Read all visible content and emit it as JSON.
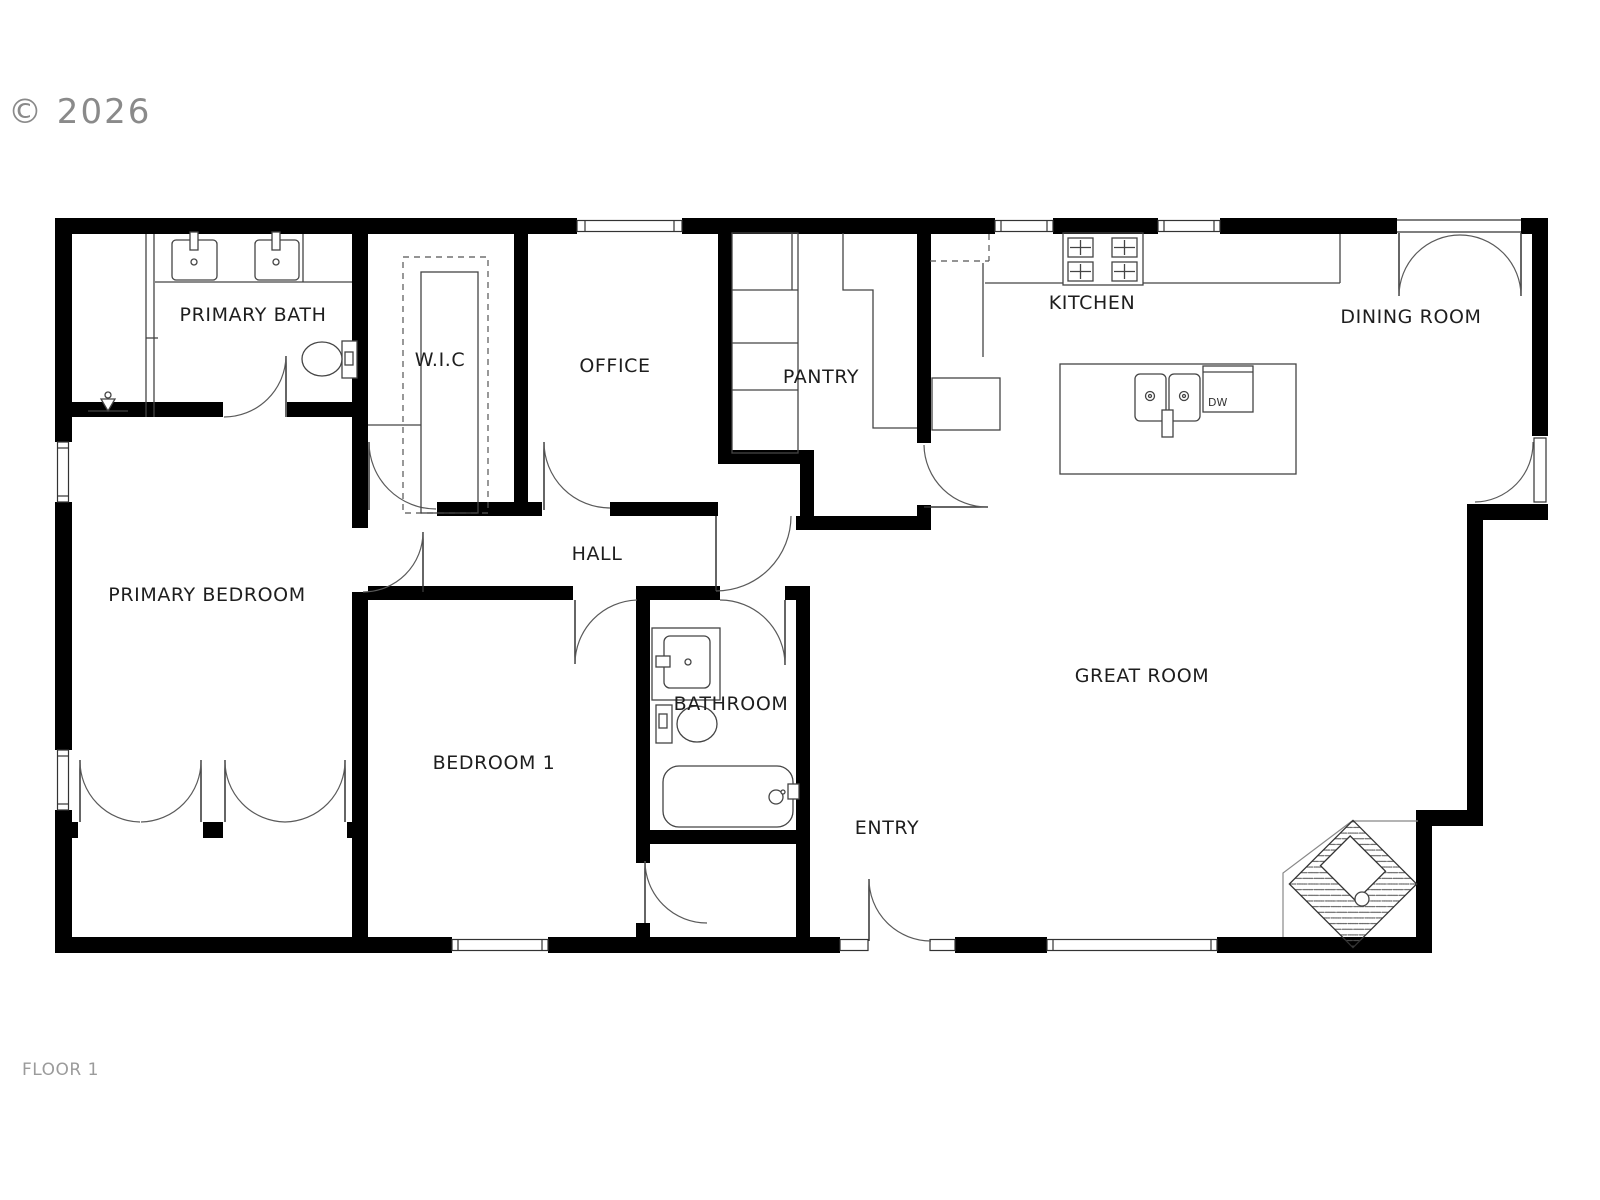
{
  "watermark": "© 2026",
  "floor": {
    "label": "FLOOR 1"
  },
  "rooms": {
    "primary_bath": "PRIMARY BATH",
    "wic": "W.I.C",
    "office": "OFFICE",
    "pantry": "PANTRY",
    "kitchen": "KITCHEN",
    "dining_room": "DINING ROOM",
    "hall": "HALL",
    "primary_bedroom": "PRIMARY BEDROOM",
    "bedroom_1": "BEDROOM 1",
    "bathroom": "BATHROOM",
    "entry": "ENTRY",
    "great_room": "GREAT ROOM"
  },
  "appliances": {
    "dishwasher": "DW"
  },
  "colors": {
    "background": "#ffffff",
    "walls": "#000000",
    "fixture_lines": "#444444",
    "door_arcs": "#5a5a5a",
    "label_text": "#1e1e1e",
    "muted_text": "#9b9b9b",
    "watermark_text": "#8a8a8a"
  }
}
